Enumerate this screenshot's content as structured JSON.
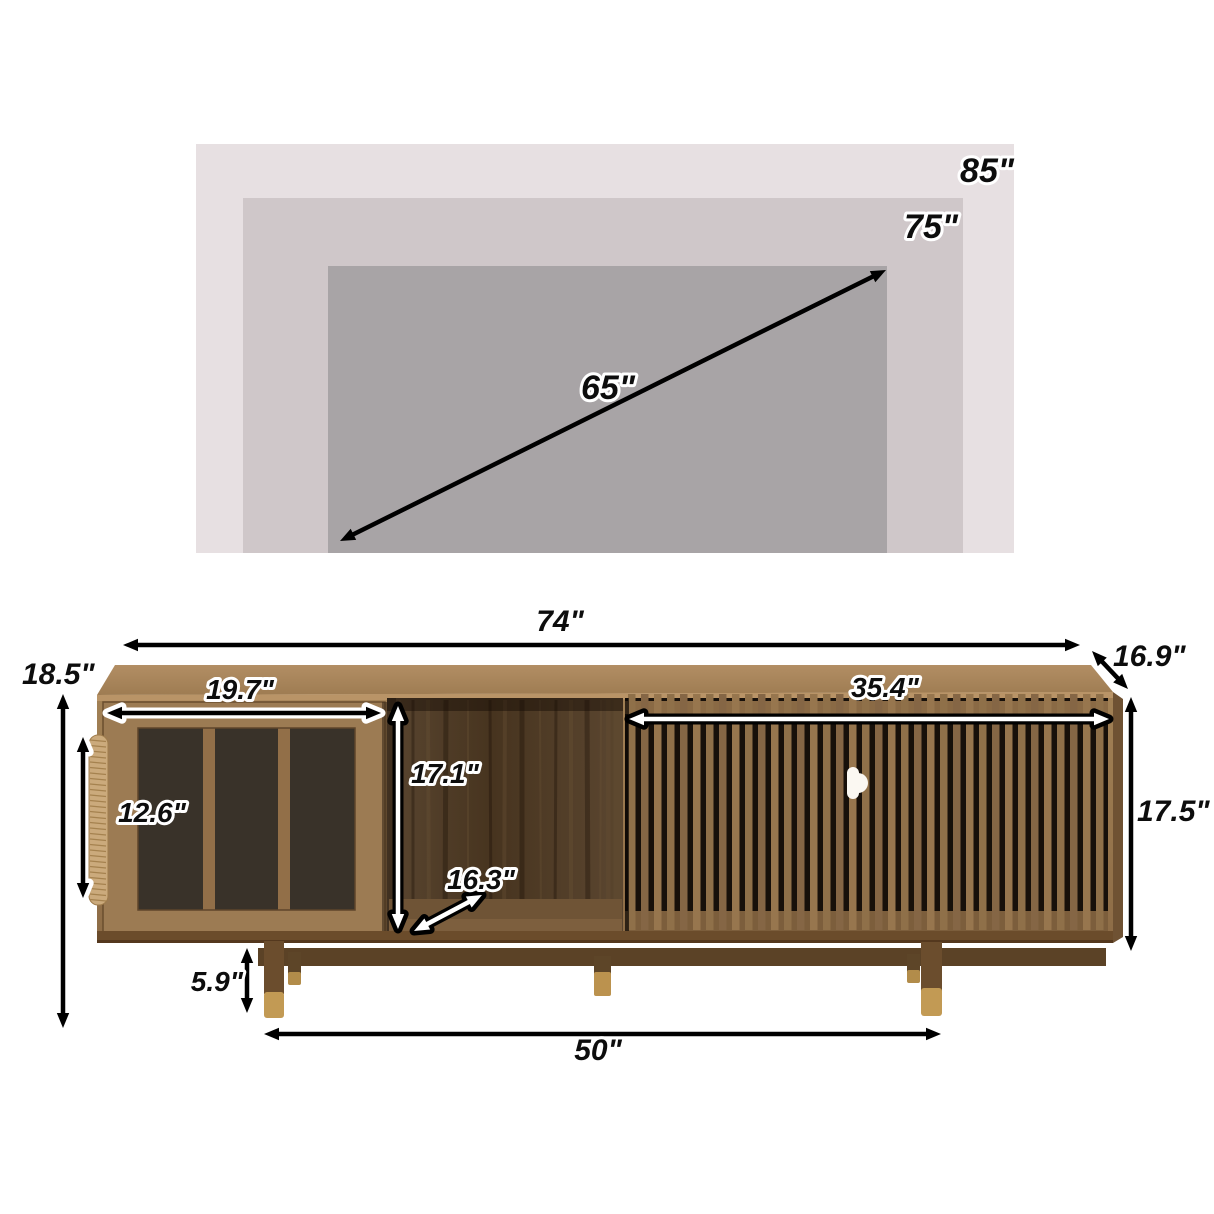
{
  "tv_diagram": {
    "description": "nested rectangles showing maximum TV sizes",
    "sizes": [
      {
        "label": "85\""
      },
      {
        "label": "75\""
      },
      {
        "label": "65\""
      }
    ]
  },
  "dimensions": {
    "overall_width": "74\"",
    "depth": "16.9\"",
    "overall_height": "18.5\"",
    "glass_door_width": "19.7\"",
    "glass_panel_height": "12.6\"",
    "open_shelf_height": "17.1\"",
    "open_shelf_depth": "16.3\"",
    "slat_door_width": "35.4\"",
    "cabinet_body_height": "17.5\"",
    "leg_height": "5.9\"",
    "leg_span": "50\""
  },
  "palette": {
    "tv_rect_85": "#e7e0e2",
    "tv_rect_75": "#cfc7c9",
    "tv_rect_65": "#a8a4a6",
    "walnut_top": "#a9865d",
    "walnut_front": "#97764e",
    "interior_dark": "#4e3a26",
    "slat_gap": "#17100a",
    "brass_foot": "#c09a55",
    "rope_handle": "#cbaa7c",
    "dimension_line": "#000000"
  }
}
